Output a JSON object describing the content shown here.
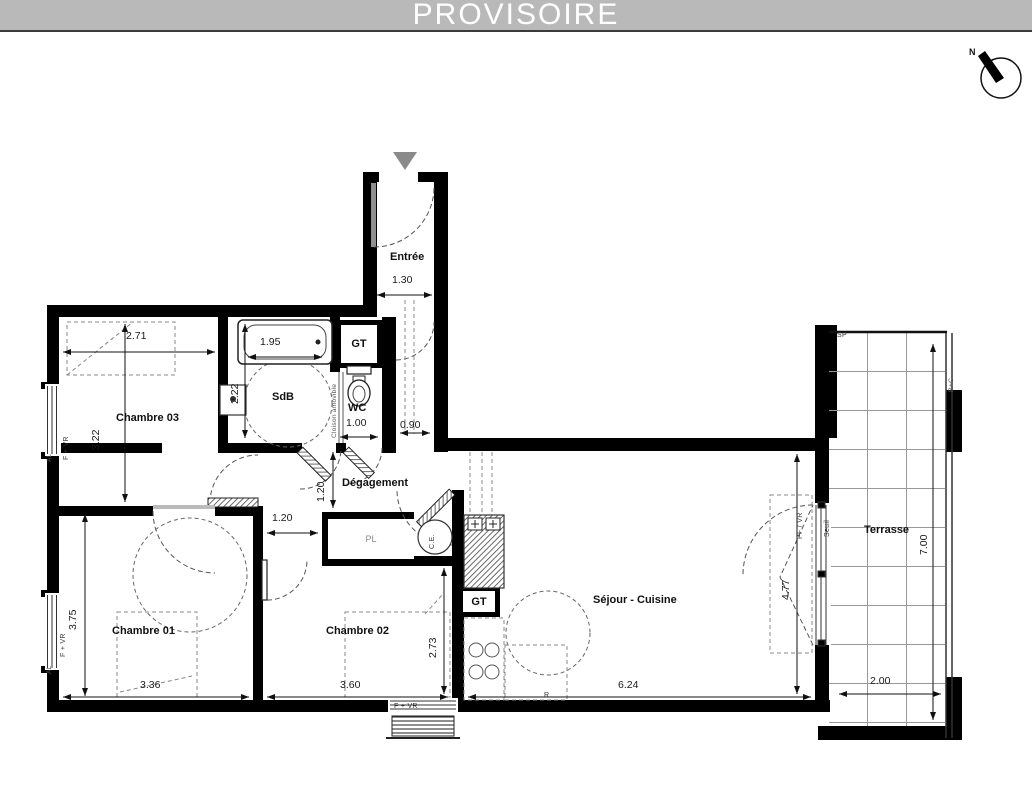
{
  "banner": {
    "title": "PROVISOIRE"
  },
  "compass": {
    "north": "N"
  },
  "rooms": {
    "entree": "Entrée",
    "sdb": "SdB",
    "wc": "WC",
    "chambre03": "Chambre 03",
    "degagement": "Dégagement",
    "chambre01": "Chambre 01",
    "chambre02": "Chambre 02",
    "sejour_cuisine": "Séjour - Cuisine",
    "terrasse": "Terrasse"
  },
  "fixtures": {
    "gt_sdb": "GT",
    "gt_cuisine": "GT",
    "placard": "PL",
    "chauffe_eau": "C.E.",
    "cloison_amovible": "Cloison amovible",
    "seuil": "Seuil",
    "porte_fenetre": "PF / VR",
    "fenetre_ch03": "F + VR",
    "allege_ch03": "AL",
    "fenetre_ch01": "F + VR",
    "allege_ch01": "AL",
    "fenetre_ch02": "F + VR",
    "sp": "SP",
    "refrigerateur": "R",
    "releve_chute": "R+C"
  },
  "dimensions": {
    "entree_largeur": "1.30",
    "chambre03_largeur": "2.71",
    "baignoire_longueur": "1.95",
    "sdb_profondeur": "2.22",
    "chambre03_profondeur": "3.22",
    "wc_largeur": "1.00",
    "couloir_largeur": "0.90",
    "degagement_profondeur": "1.20",
    "degagement_largeur": "1.20",
    "chambre01_profondeur": "3.75",
    "chambre01_largeur": "3.36",
    "chambre02_largeur": "3.60",
    "chambre02_profondeur": "2.73",
    "sejour_largeur": "6.24",
    "sejour_profondeur": "4.77",
    "terrasse_profondeur": "7.00",
    "terrasse_largeur": "2.00"
  },
  "colors": {
    "banner_bg": "#b9b9b9",
    "banner_text": "#ffffff",
    "wall": "#000000",
    "dim_text": "#1a1a1a",
    "door_swing": "#555555"
  }
}
